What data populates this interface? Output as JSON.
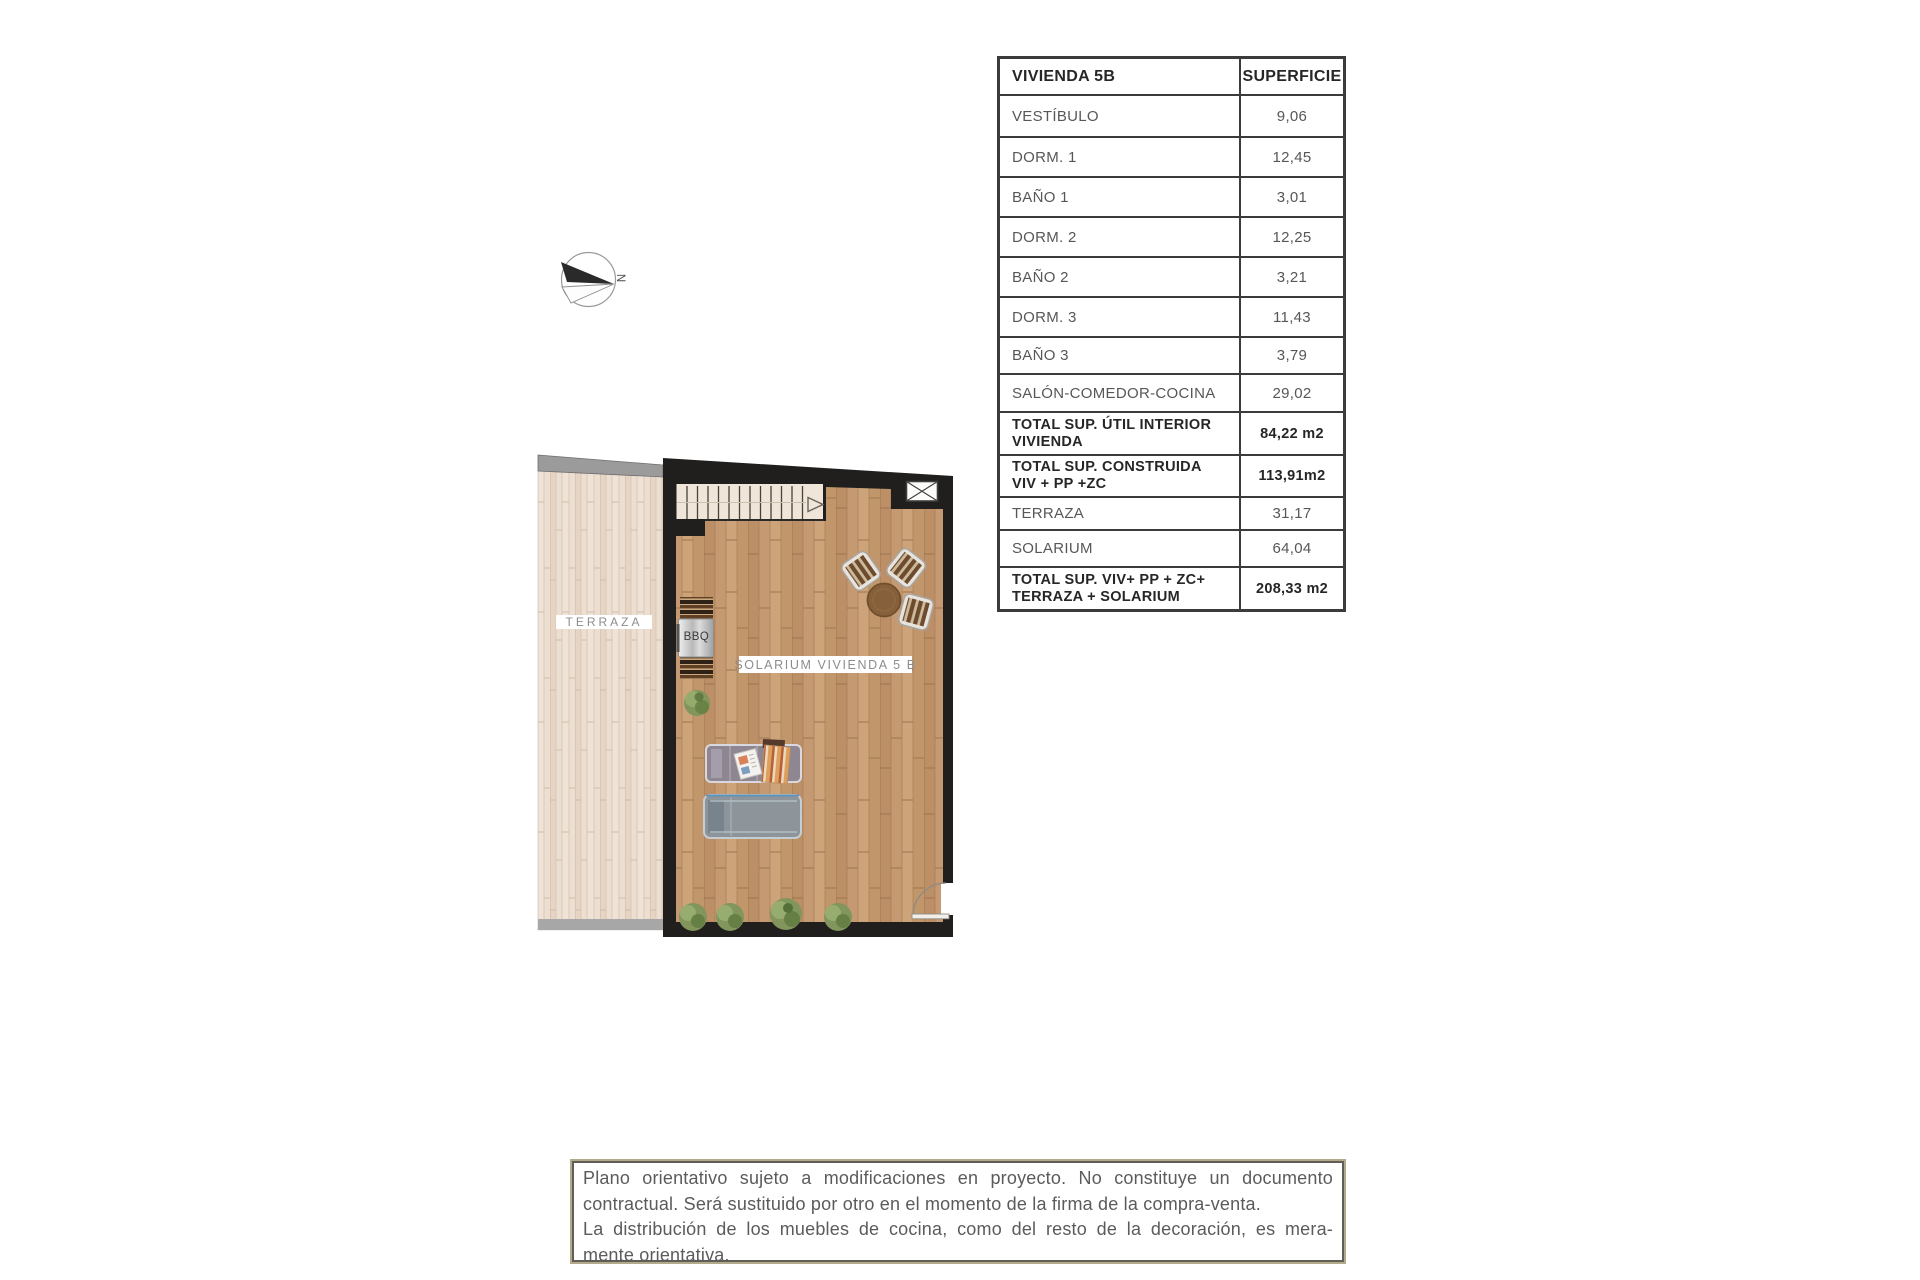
{
  "plan": {
    "labels": {
      "terraza": "TERRAZA",
      "solarium": "SOLARIUM VIVIENDA 5 B",
      "bbq": "BBQ"
    },
    "compass": {
      "label": "N"
    },
    "colors": {
      "wall": "#211f1d",
      "solarium_floor": "#c59a72",
      "terrace_floor": "#ecdfd2",
      "terrace_edge": "#9b9b9b",
      "plant_green": "#81955c"
    }
  },
  "area_table": {
    "header": {
      "col1": "VIVIENDA 5B",
      "col2": "SUPERFICIE"
    },
    "rows": [
      {
        "label": "VESTÍBULO",
        "value": "9,06"
      },
      {
        "label": "DORM. 1",
        "value": "12,45"
      },
      {
        "label": "BAÑO 1",
        "value": "3,01"
      },
      {
        "label": "DORM. 2",
        "value": "12,25"
      },
      {
        "label": "BAÑO 2",
        "value": "3,21"
      },
      {
        "label": "DORM. 3",
        "value": "11,43"
      },
      {
        "label": "BAÑO 3",
        "value": "3,79"
      },
      {
        "label": "SALÓN-COMEDOR-COCINA",
        "value": "29,02"
      },
      {
        "label": "TOTAL SUP. ÚTIL INTERIOR\nVIVIENDA",
        "value": "84,22 m2"
      },
      {
        "label": "TOTAL SUP. CONSTRUIDA\nVIV + PP +ZC",
        "value": "113,91m2"
      },
      {
        "label": "TERRAZA",
        "value": "31,17"
      },
      {
        "label": "SOLARIUM",
        "value": "64,04"
      },
      {
        "label": "TOTAL SUP. VIV+ PP + ZC+\nTERRAZA + SOLARIUM",
        "value": "208,33 m2"
      }
    ]
  },
  "disclaimer": {
    "lines": [
      "Plano orientativo sujeto a modificaciones en proyecto. No constituye un documento",
      "contractual. Será sustituido por otro en el momento de la firma de la compra-venta.",
      "La distribución de los muebles de cocina, como del resto de la decoración, es mera-",
      "mente orientativa."
    ]
  }
}
